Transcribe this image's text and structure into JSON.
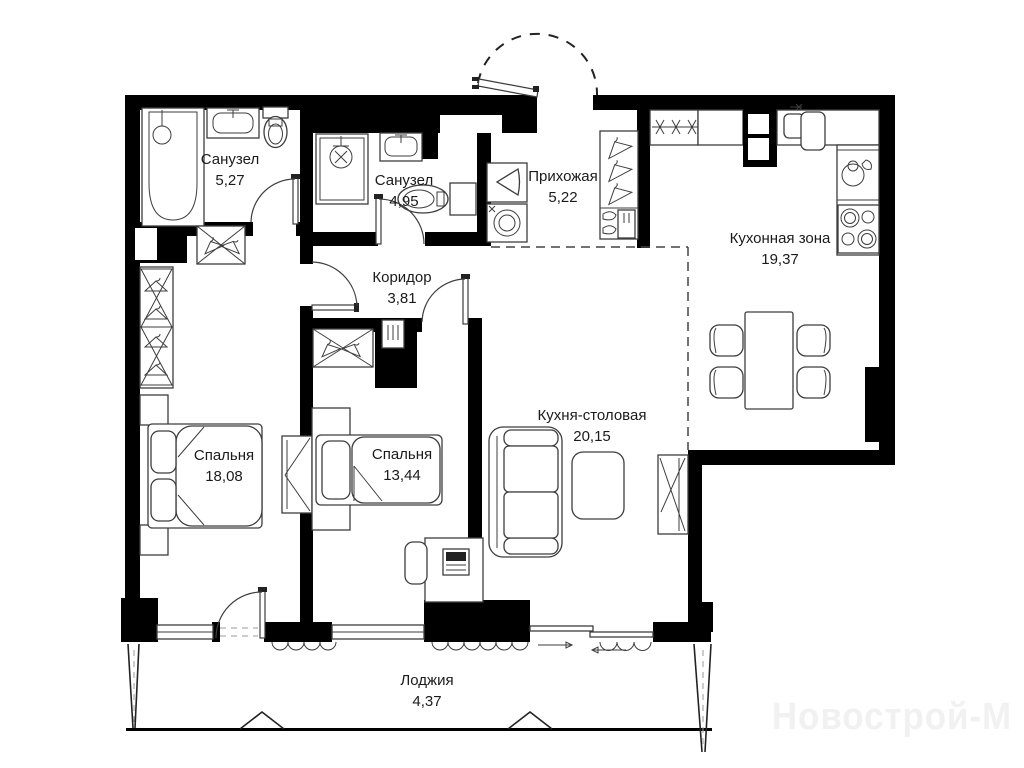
{
  "plan": {
    "rooms": [
      {
        "name": "Санузел",
        "area": "5,27"
      },
      {
        "name": "Санузел",
        "area": "4,95"
      },
      {
        "name": "Прихожая",
        "area": "5,22"
      },
      {
        "name": "Кухонная зона",
        "area": "19,37"
      },
      {
        "name": "Коридор",
        "area": "3,81"
      },
      {
        "name": "Кухня-столовая",
        "area": "20,15"
      },
      {
        "name": "Спальня",
        "area": "18,08"
      },
      {
        "name": "Спальня",
        "area": "13,44"
      },
      {
        "name": "Лоджия",
        "area": "4,37"
      }
    ],
    "watermark": "Новострой-М",
    "colors": {
      "wall": "#000000",
      "background": "#ffffff",
      "fixture_line": "#3d3d3d",
      "label": "#1b1b1b",
      "watermark": "#f1f1f1"
    }
  }
}
